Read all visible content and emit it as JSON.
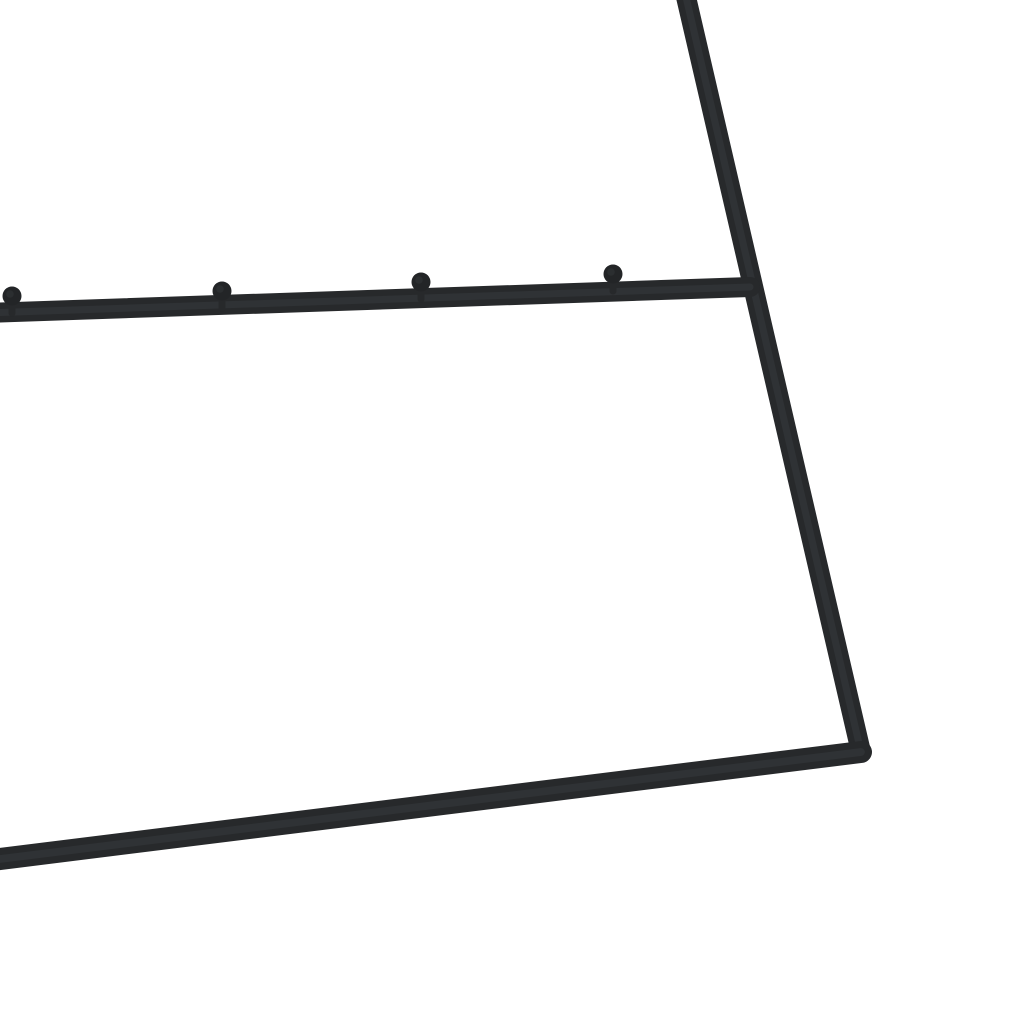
{
  "photo": {
    "subject": "black-metal-coat-rack-frame-closeup",
    "viewbox": "0 0 1024 1024",
    "background_color": "#ffffff",
    "metal": {
      "stroke_color": "#27292b",
      "ball_color": "#232527",
      "highlight_color": "#3d4145",
      "highlight_opacity": 0.4
    },
    "frame": {
      "top_rail": {
        "x1": -16,
        "y1": 313,
        "x2": 750,
        "y2": 287,
        "width": 20
      },
      "upright": {
        "x1": 683,
        "y1": -16,
        "x2": 861,
        "y2": 752,
        "width": 20
      },
      "bottom_rail": {
        "x1": 861,
        "y1": 752,
        "x2": -16,
        "y2": 861,
        "width": 22
      },
      "pegs": {
        "radius": 9.5,
        "stem_width": 7,
        "stem_drop": 17,
        "centers": [
          {
            "cx": 12,
            "cy": 296
          },
          {
            "cx": 222,
            "cy": 291
          },
          {
            "cx": 421,
            "cy": 282
          },
          {
            "cx": 613,
            "cy": 274
          }
        ]
      }
    }
  }
}
